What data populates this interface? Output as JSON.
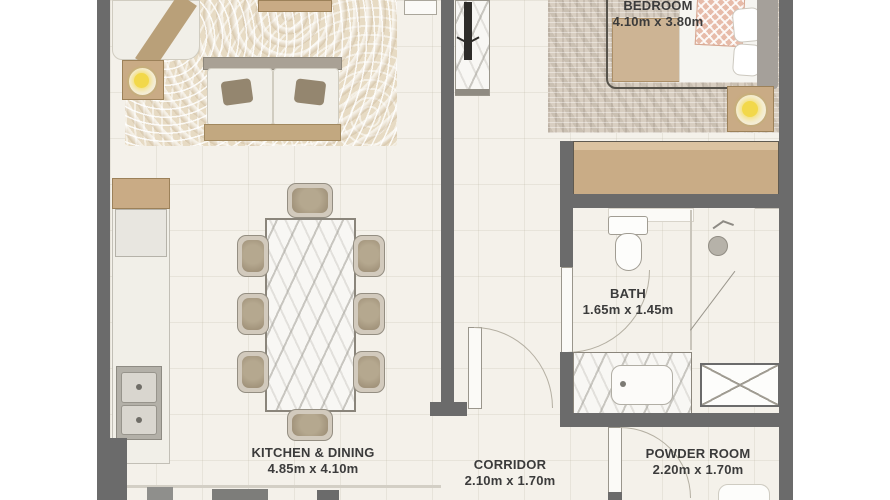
{
  "floorplan": {
    "rooms": {
      "bedroom": {
        "name": "BEDROOM",
        "dimensions": "4.10m x 3.80m"
      },
      "kitchen_dining": {
        "name": "KITCHEN & DINING",
        "dimensions": "4.85m x 4.10m"
      },
      "corridor": {
        "name": "CORRIDOR",
        "dimensions": "2.10m x 1.70m"
      },
      "bath": {
        "name": "BATH",
        "dimensions": "1.65m x 1.45m"
      },
      "powder_room": {
        "name": "POWDER ROOM",
        "dimensions": "2.20m x 1.70m"
      }
    },
    "colors": {
      "wall": "#6b6b6b",
      "floor": "#f4f1ea",
      "wood_accent": "#c9ab85",
      "lamp_glow": "#f2d84a",
      "label_text": "#3b3b3b"
    },
    "icons": [
      "sofa",
      "armchair",
      "coffee-table",
      "table-lamp-icon",
      "tv-icon",
      "dining-table",
      "dining-chair",
      "kitchen-counter",
      "kitchen-sink-icon",
      "bed",
      "nightstand-lamp-icon",
      "wardrobe",
      "toilet-icon",
      "shower-head-icon",
      "vanity-sink-icon",
      "service-shaft-icon",
      "door-swing-icon"
    ]
  }
}
